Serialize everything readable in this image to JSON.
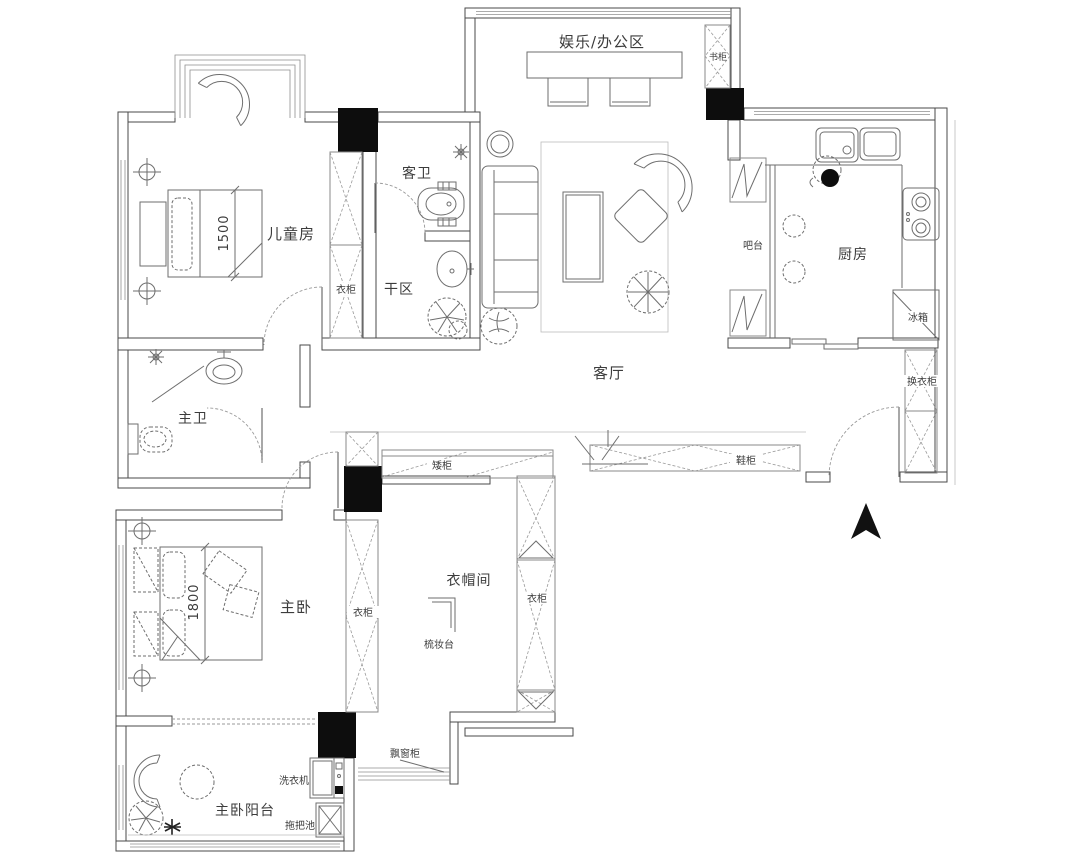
{
  "labels": {
    "office": "娱乐/办公区",
    "bookcase": "书柜",
    "children_room": "儿童房",
    "dim_children_bed": "1500",
    "wardrobe_children": "衣柜",
    "guest_bath": "客卫",
    "dry_area": "干区",
    "living_room": "客厅",
    "bar": "吧台",
    "kitchen": "厨房",
    "fridge": "冰箱",
    "changing_wardrobe": "换衣柜",
    "master_bath": "主卫",
    "low_cabinet": "矮柜",
    "shoe_cabinet": "鞋柜",
    "master_bedroom": "主卧",
    "dim_master_bed": "1800",
    "wardrobe_master": "衣柜",
    "cloakroom": "衣帽间",
    "wardrobe_cloakroom": "衣柜",
    "dressing_table": "梳妆台",
    "washing_machine": "洗衣机",
    "bay_window_cabinet": "飘窗柜",
    "master_balcony": "主卧阳台",
    "mop_sink": "拖把池"
  },
  "colors": {
    "background": "#ffffff",
    "wall_line": "#4a4a4a",
    "furniture_line": "#6e6e6e",
    "hatch_line": "#9a9a9a",
    "column_fill": "#0d0d0d",
    "text": "#3c3c3c"
  }
}
